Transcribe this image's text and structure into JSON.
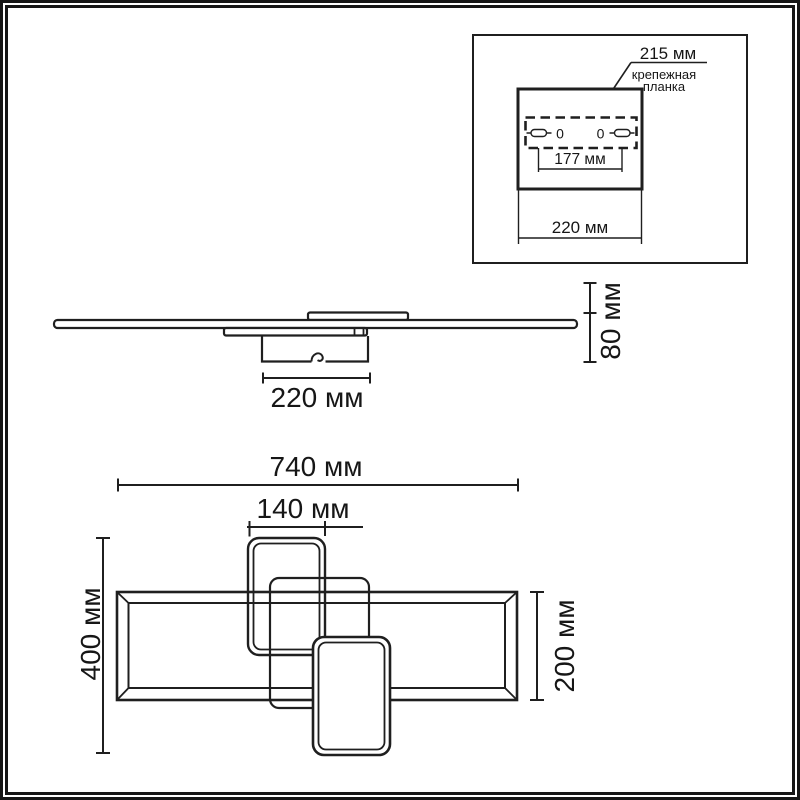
{
  "colors": {
    "background": "#ffffff",
    "line": "#1f1f1f",
    "text": "#161616",
    "border": "#161616"
  },
  "inset": {
    "dim_215": "215 мм",
    "mount_label_line1": "крепежная",
    "mount_label_line2": "планка",
    "dim_177": "177 мм",
    "dim_220": "220 мм",
    "hole_left": "0",
    "hole_right": "0"
  },
  "side_view": {
    "dim_220": "220 мм",
    "dim_80": "80 мм"
  },
  "top_view": {
    "dim_740": "740 мм",
    "dim_140": "140 мм",
    "dim_400": "400 мм",
    "dim_200": "200 мм"
  }
}
